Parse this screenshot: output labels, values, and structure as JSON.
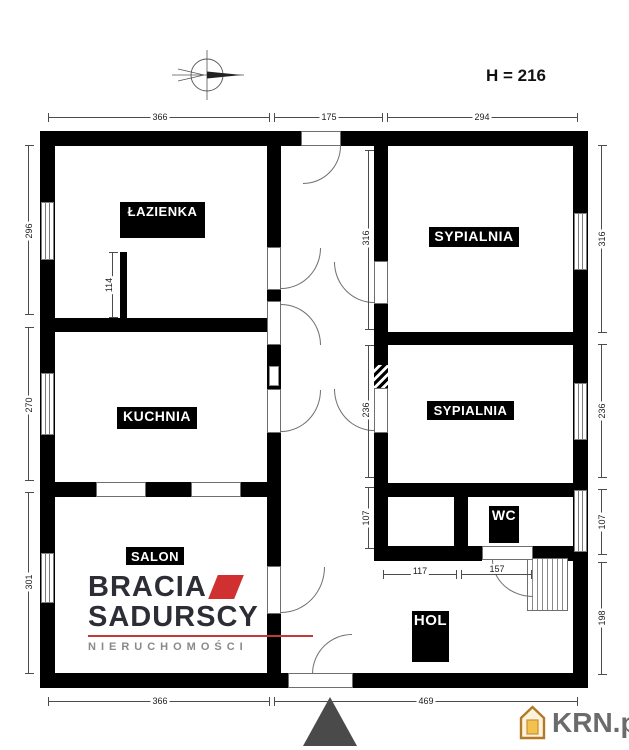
{
  "header": {
    "ceiling_height": "H = 216"
  },
  "rooms": {
    "bathroom": "ŁAZIENKA",
    "bedroom_top": "SYPIALNIA",
    "kitchen": "KUCHNIA",
    "bedroom_mid": "SYPIALNIA",
    "living_room": "SALON",
    "wc": "WC",
    "hall": "HOL"
  },
  "dims": {
    "top": [
      "366",
      "175",
      "294"
    ],
    "bottom": [
      "366",
      "469"
    ],
    "left": [
      "296",
      "270",
      "301"
    ],
    "right": [
      "316",
      "236",
      "107",
      "198"
    ],
    "inner": [
      "316",
      "236",
      "107"
    ],
    "partition": "114",
    "storage_width": "117",
    "wc_width": "157"
  },
  "branding": {
    "agency_line1": "BRACIA",
    "agency_line2": "SADURSCY",
    "agency_line3": "NIERUCHOMOŚCI",
    "portal": "KRN.pl"
  },
  "colors": {
    "wall": "#000000",
    "accent_red": "#d03030",
    "logo_dark": "#2d2d35",
    "portal_gray": "#6b6b6b",
    "arrow_gray": "#4a4a4a"
  }
}
